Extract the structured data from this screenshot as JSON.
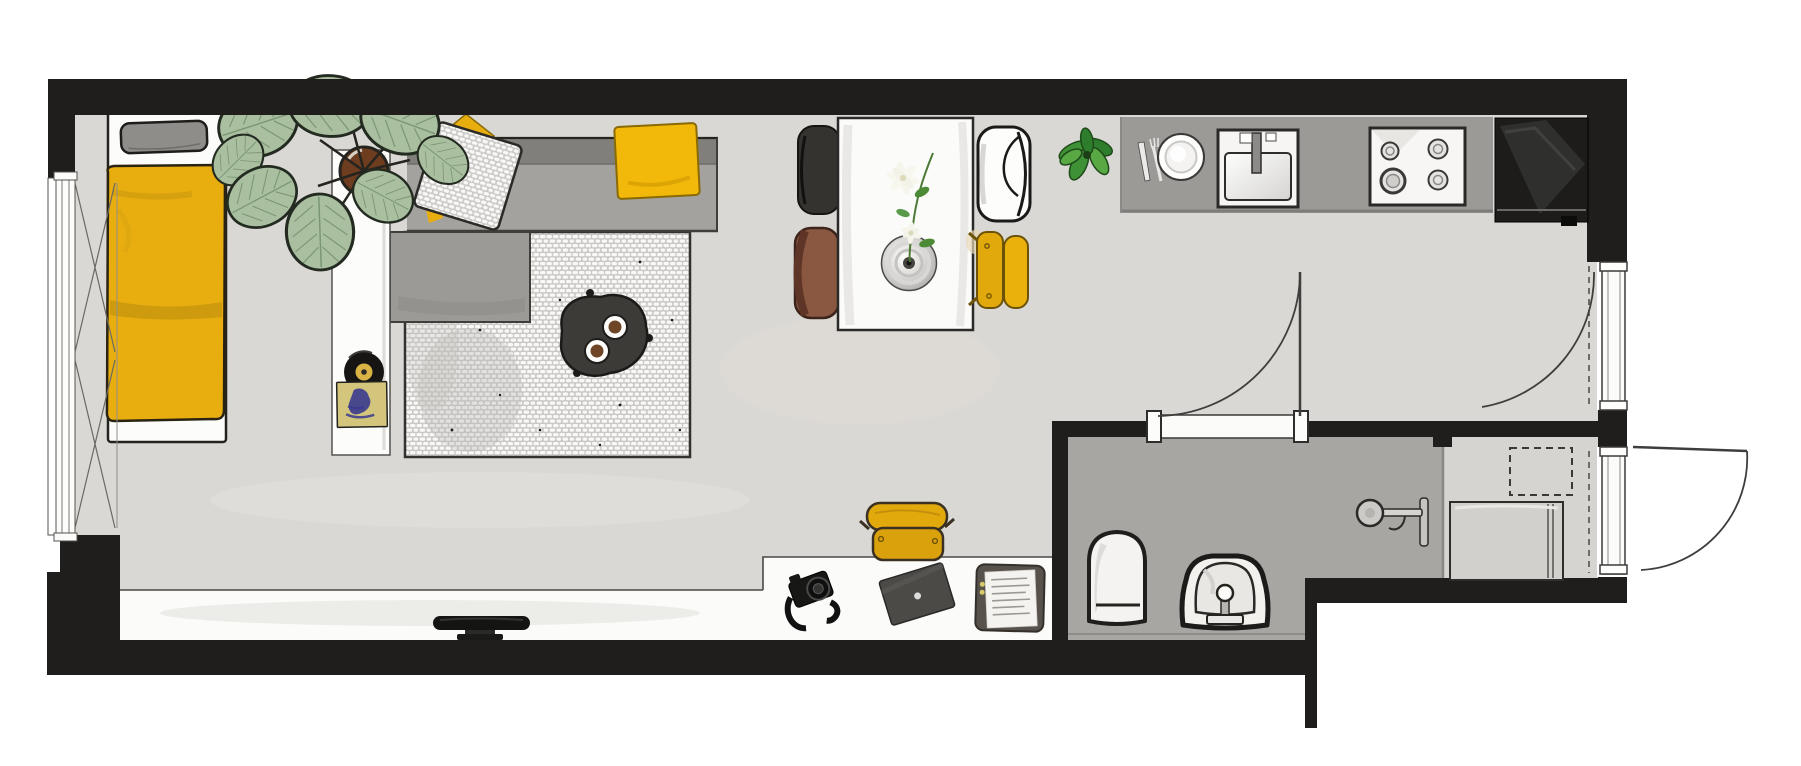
{
  "meta": {
    "label": "studio-apartment-floor-plan",
    "type": "architectural-floor-plan-top-view"
  },
  "palette": {
    "wall": "#201e1c",
    "floor": "#dad8d4",
    "strip": "#fbfbf9",
    "bath_floor": "#a8a6a2",
    "nook_floor": "#d6d4d0",
    "counter": "#9c9a97",
    "sofa_back": "#807f7c",
    "sofa_seat": "#a4a29e",
    "chaise": "#9c9a96",
    "rug_brick": "#f9f8f6",
    "rug_gap": "#cbc9c6",
    "yellow": "#e8ae10",
    "yellow_bright": "#f2b90a",
    "chair_yellow": "#e2a90d",
    "charcoal": "#3d3b38",
    "brown": "#8a5741",
    "leaf": "#a9bfa0",
    "leaf_dark": "#93ae8a",
    "plant_green": "#3f9136",
    "pot": "#6e3c1e",
    "white": "#fcfcfb",
    "outline": "#26241f"
  },
  "legend": {
    "rooms": [
      "sleeping-area",
      "living-area",
      "dining-area",
      "kitchen",
      "desk-area",
      "bathroom",
      "laundry-nook",
      "entry"
    ],
    "furniture_icons": [
      "window-icon",
      "bed-icon",
      "pillow-icon",
      "duvet-icon",
      "sideboard-icon",
      "vinyl-record-icon",
      "large-plant-icon",
      "l-sofa-icon",
      "yellow-cushion-icon",
      "textured-cushion-icon",
      "yellow-blanket-icon",
      "rug-icon",
      "coffee-table-icon",
      "coffee-cup-icon",
      "dining-table-icon",
      "flower-bowl-icon",
      "black-chair-icon",
      "brown-chair-icon",
      "white-chair-icon",
      "yellow-chair-icon",
      "small-plant-icon",
      "kitchen-counter-icon",
      "cutlery-icon",
      "plate-icon",
      "sink-icon",
      "stove-icon",
      "fridge-icon",
      "media-bench-icon",
      "tv-icon",
      "desk-icon",
      "desk-chair-icon",
      "camera-icon",
      "laptop-icon",
      "clipboard-icon",
      "bath-sink-icon",
      "toilet-icon",
      "shower-icon",
      "washing-machine-icon",
      "dashed-cabinet-icon",
      "door-swing-icon",
      "door-threshold-icon"
    ]
  }
}
